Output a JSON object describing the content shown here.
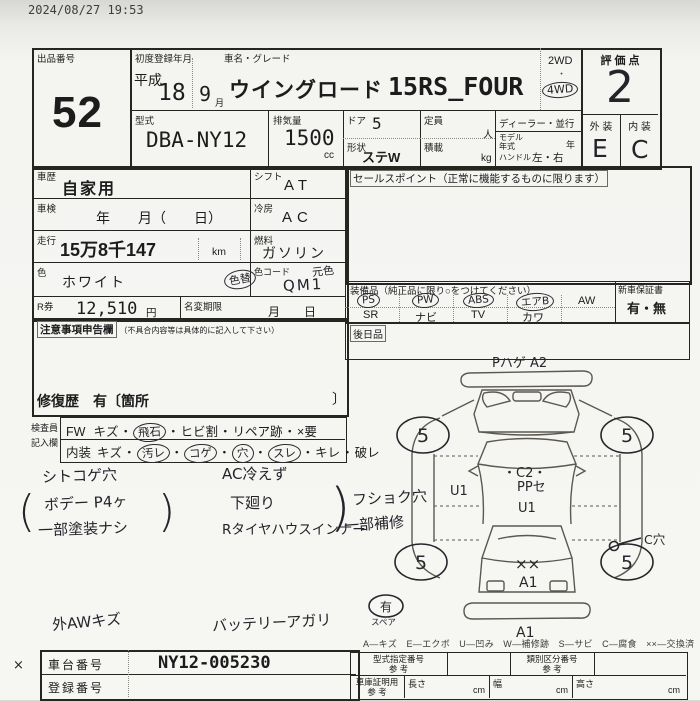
{
  "sep": "・",
  "meta": {
    "timestamp": "2024/08/27 19:53",
    "margin_mark": "×"
  },
  "header": {
    "auction_label": "出品番号",
    "auction_no": "52",
    "firstreg_label": "初度登録年月",
    "era": "平成",
    "year": "18",
    "month": "9",
    "month_unit": "月",
    "name_label": "車名・グレード",
    "car_name": "ウイングロード",
    "grade": "15RS_FOUR",
    "wd2": "2WD",
    "wd_dot": "・",
    "wd4": "4WD",
    "score_label": "評 価 点",
    "score": "2",
    "ext_label": "外 装",
    "int_label": "内 装",
    "ext_grade": "E",
    "int_grade": "C"
  },
  "spec": {
    "model_label": "型式",
    "model": "DBA-NY12",
    "disp_label": "排気量",
    "disp": "1500",
    "disp_unit": "cc",
    "door_label": "ドア",
    "door": "5",
    "shape_label": "形状",
    "shape": "ステW",
    "cap_label": "定員",
    "cap_unit": "人",
    "load_label": "積載",
    "load_unit": "kg",
    "dealer_label": "ディーラー・並行",
    "modelyear_label": "モデル年式",
    "year_unit": "年",
    "handle_label": "ハンドル",
    "handle_val": "左・右"
  },
  "left": {
    "history_label": "車歴",
    "history": "自家用",
    "shift_label": "シフト",
    "shift": "AT",
    "shaken_label": "車検",
    "shaken_val": "年　　月（　　日）",
    "cool_label": "冷房",
    "cool": "AC",
    "mileage_label": "走行",
    "mileage": "15万8千147",
    "mileage_unit": "km",
    "fuel_label": "燃料",
    "fuel": "ガソリン",
    "color_label": "色",
    "color": "ホワイト",
    "color_change": "色替",
    "colorcode_label": "色コード",
    "original_color": "元色",
    "color_code": "QM1",
    "rticket_label": "R券",
    "rticket": "12,510",
    "yen": "円",
    "namechange_label": "名変期限",
    "namechange_val": "月　　日"
  },
  "sales": {
    "label": "セールスポイント（正常に機能するものに限ります）"
  },
  "equipment": {
    "label": "装備品（純正品に限り○をつけてください）",
    "top": [
      "PS",
      "PW",
      "ABS",
      "エアB",
      "AW"
    ],
    "bottom": [
      "SR",
      "ナビ",
      "TV",
      "カワ"
    ],
    "warranty_label": "新車保証書",
    "warranty_val": "有・無",
    "later_label": "後日品"
  },
  "caution": {
    "label": "注意事項申告欄",
    "sublabel": "（不具合内容等は具体的に記入して下さい）",
    "repair_text": "修復歴　有〔箇所",
    "repair_close": "〕"
  },
  "inspector": {
    "label1": "検査員",
    "label2": "記入欄",
    "fw_label": "FW",
    "fw": [
      "キズ",
      "飛石",
      "ヒビ割",
      "リペア跡",
      "×要"
    ],
    "int_label": "内装",
    "int": [
      "キズ",
      "汚レ",
      "コゲ",
      "穴",
      "スレ",
      "キレ",
      "破レ"
    ]
  },
  "notes": {
    "seat": "シトコゲ穴",
    "paren_open": "(",
    "paren_close": ")",
    "body1": "ボデー P4ヶ",
    "body2": "一部塗装ナシ",
    "ac": "AC冷えず",
    "under": "下廻り",
    "tirehouse": "Rタイヤハウスインナー",
    "brace": ")",
    "fushoku1": "フショク穴",
    "fushoku2": "一部補修",
    "aw": "外AWキズ",
    "battery": "バッテリーアガリ"
  },
  "diagram": {
    "top_mark": "Pハゲ A2",
    "wheel": "5",
    "u1_left": "U1",
    "c2": "・C2・",
    "ppse": "PPセ",
    "u1_mid": "U1",
    "c_hole": "C穴",
    "xx": "××",
    "a1_gate": "A1",
    "a1_bumper": "A1",
    "spare_mark": "有",
    "spare_label": "スペア"
  },
  "legend": "A―キズ　E―エクボ　U―凹み　W―補修跡　S―サビ　C―腐食　××―交換済",
  "bottom": {
    "chassis_label": "車台番号",
    "chassis": "NY12-005230",
    "reg_label": "登録番号",
    "typeno_label": "型式指定番号",
    "ref": "参 考",
    "classno_label": "類別区分番号",
    "garage_label": "車庫証明用",
    "len_label": "長さ",
    "wid_label": "幅",
    "hgt_label": "高さ",
    "cm": "cm"
  }
}
